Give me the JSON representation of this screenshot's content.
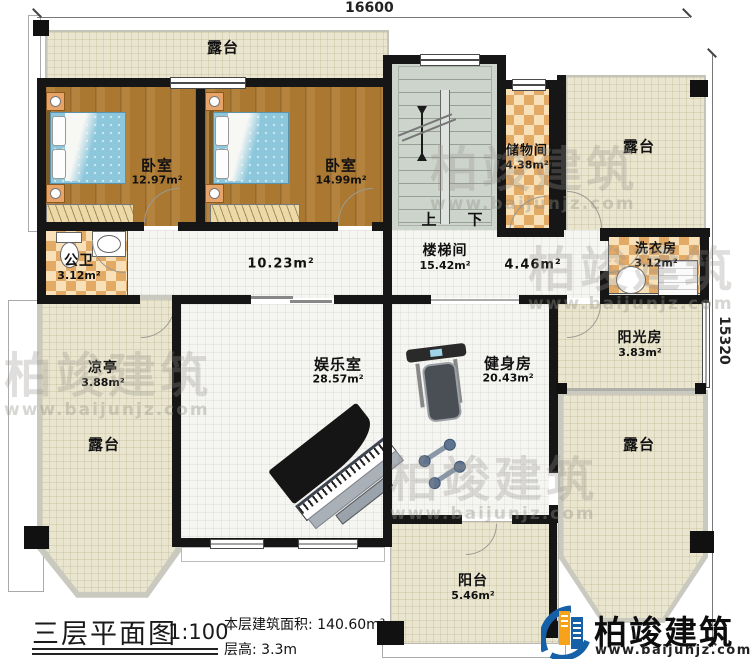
{
  "dimensions": {
    "top": "16600",
    "right": "15320"
  },
  "rooms": {
    "terrace_top": {
      "label": "露台"
    },
    "bedroom_left": {
      "label": "卧室",
      "area": "12.97m²"
    },
    "bedroom_right": {
      "label": "卧室",
      "area": "14.99m²"
    },
    "storage": {
      "label": "储物间",
      "area": "4.38m²"
    },
    "terrace_top_right": {
      "label": "露台"
    },
    "public_bath": {
      "label": "公卫",
      "area": "3.12m²"
    },
    "corridor": {
      "area": "10.23m²"
    },
    "stairwell": {
      "label": "楼梯间",
      "area": "15.42m²"
    },
    "hall": {
      "area": "4.46m²"
    },
    "laundry": {
      "label": "洗衣房",
      "area": "3.12m²"
    },
    "pavilion": {
      "label": "凉亭",
      "area": "3.88m²"
    },
    "terrace_left": {
      "label": "露台"
    },
    "entertainment": {
      "label": "娱乐室",
      "area": "28.57m²"
    },
    "gym": {
      "label": "健身房",
      "area": "20.43m²"
    },
    "sunroom": {
      "label": "阳光房",
      "area": "3.83m²"
    },
    "terrace_bottom_right": {
      "label": "露台"
    },
    "balcony": {
      "label": "阳台",
      "area": "5.46m²"
    }
  },
  "stairs": {
    "up": "上",
    "down": "下"
  },
  "title_block": {
    "title": "三层平面图",
    "scale": "1:100",
    "area_note": "本层建筑面积: 140.60m²",
    "height_note": "层高: 3.3m"
  },
  "logo": {
    "name": "柏竣建筑",
    "url": "www.baijunjz.com"
  },
  "watermark": {
    "text": "柏竣建筑",
    "url": "www.baijunjz.com"
  },
  "colors": {
    "wall": "#161616",
    "terrace_floor": "#eae5cf",
    "wood_floor": "#ab7832",
    "checker_orange": "#e3aa66",
    "stair_floor": "#cdd4cc",
    "logo_blue": "#1660a8",
    "logo_orange": "#f7a21b"
  }
}
